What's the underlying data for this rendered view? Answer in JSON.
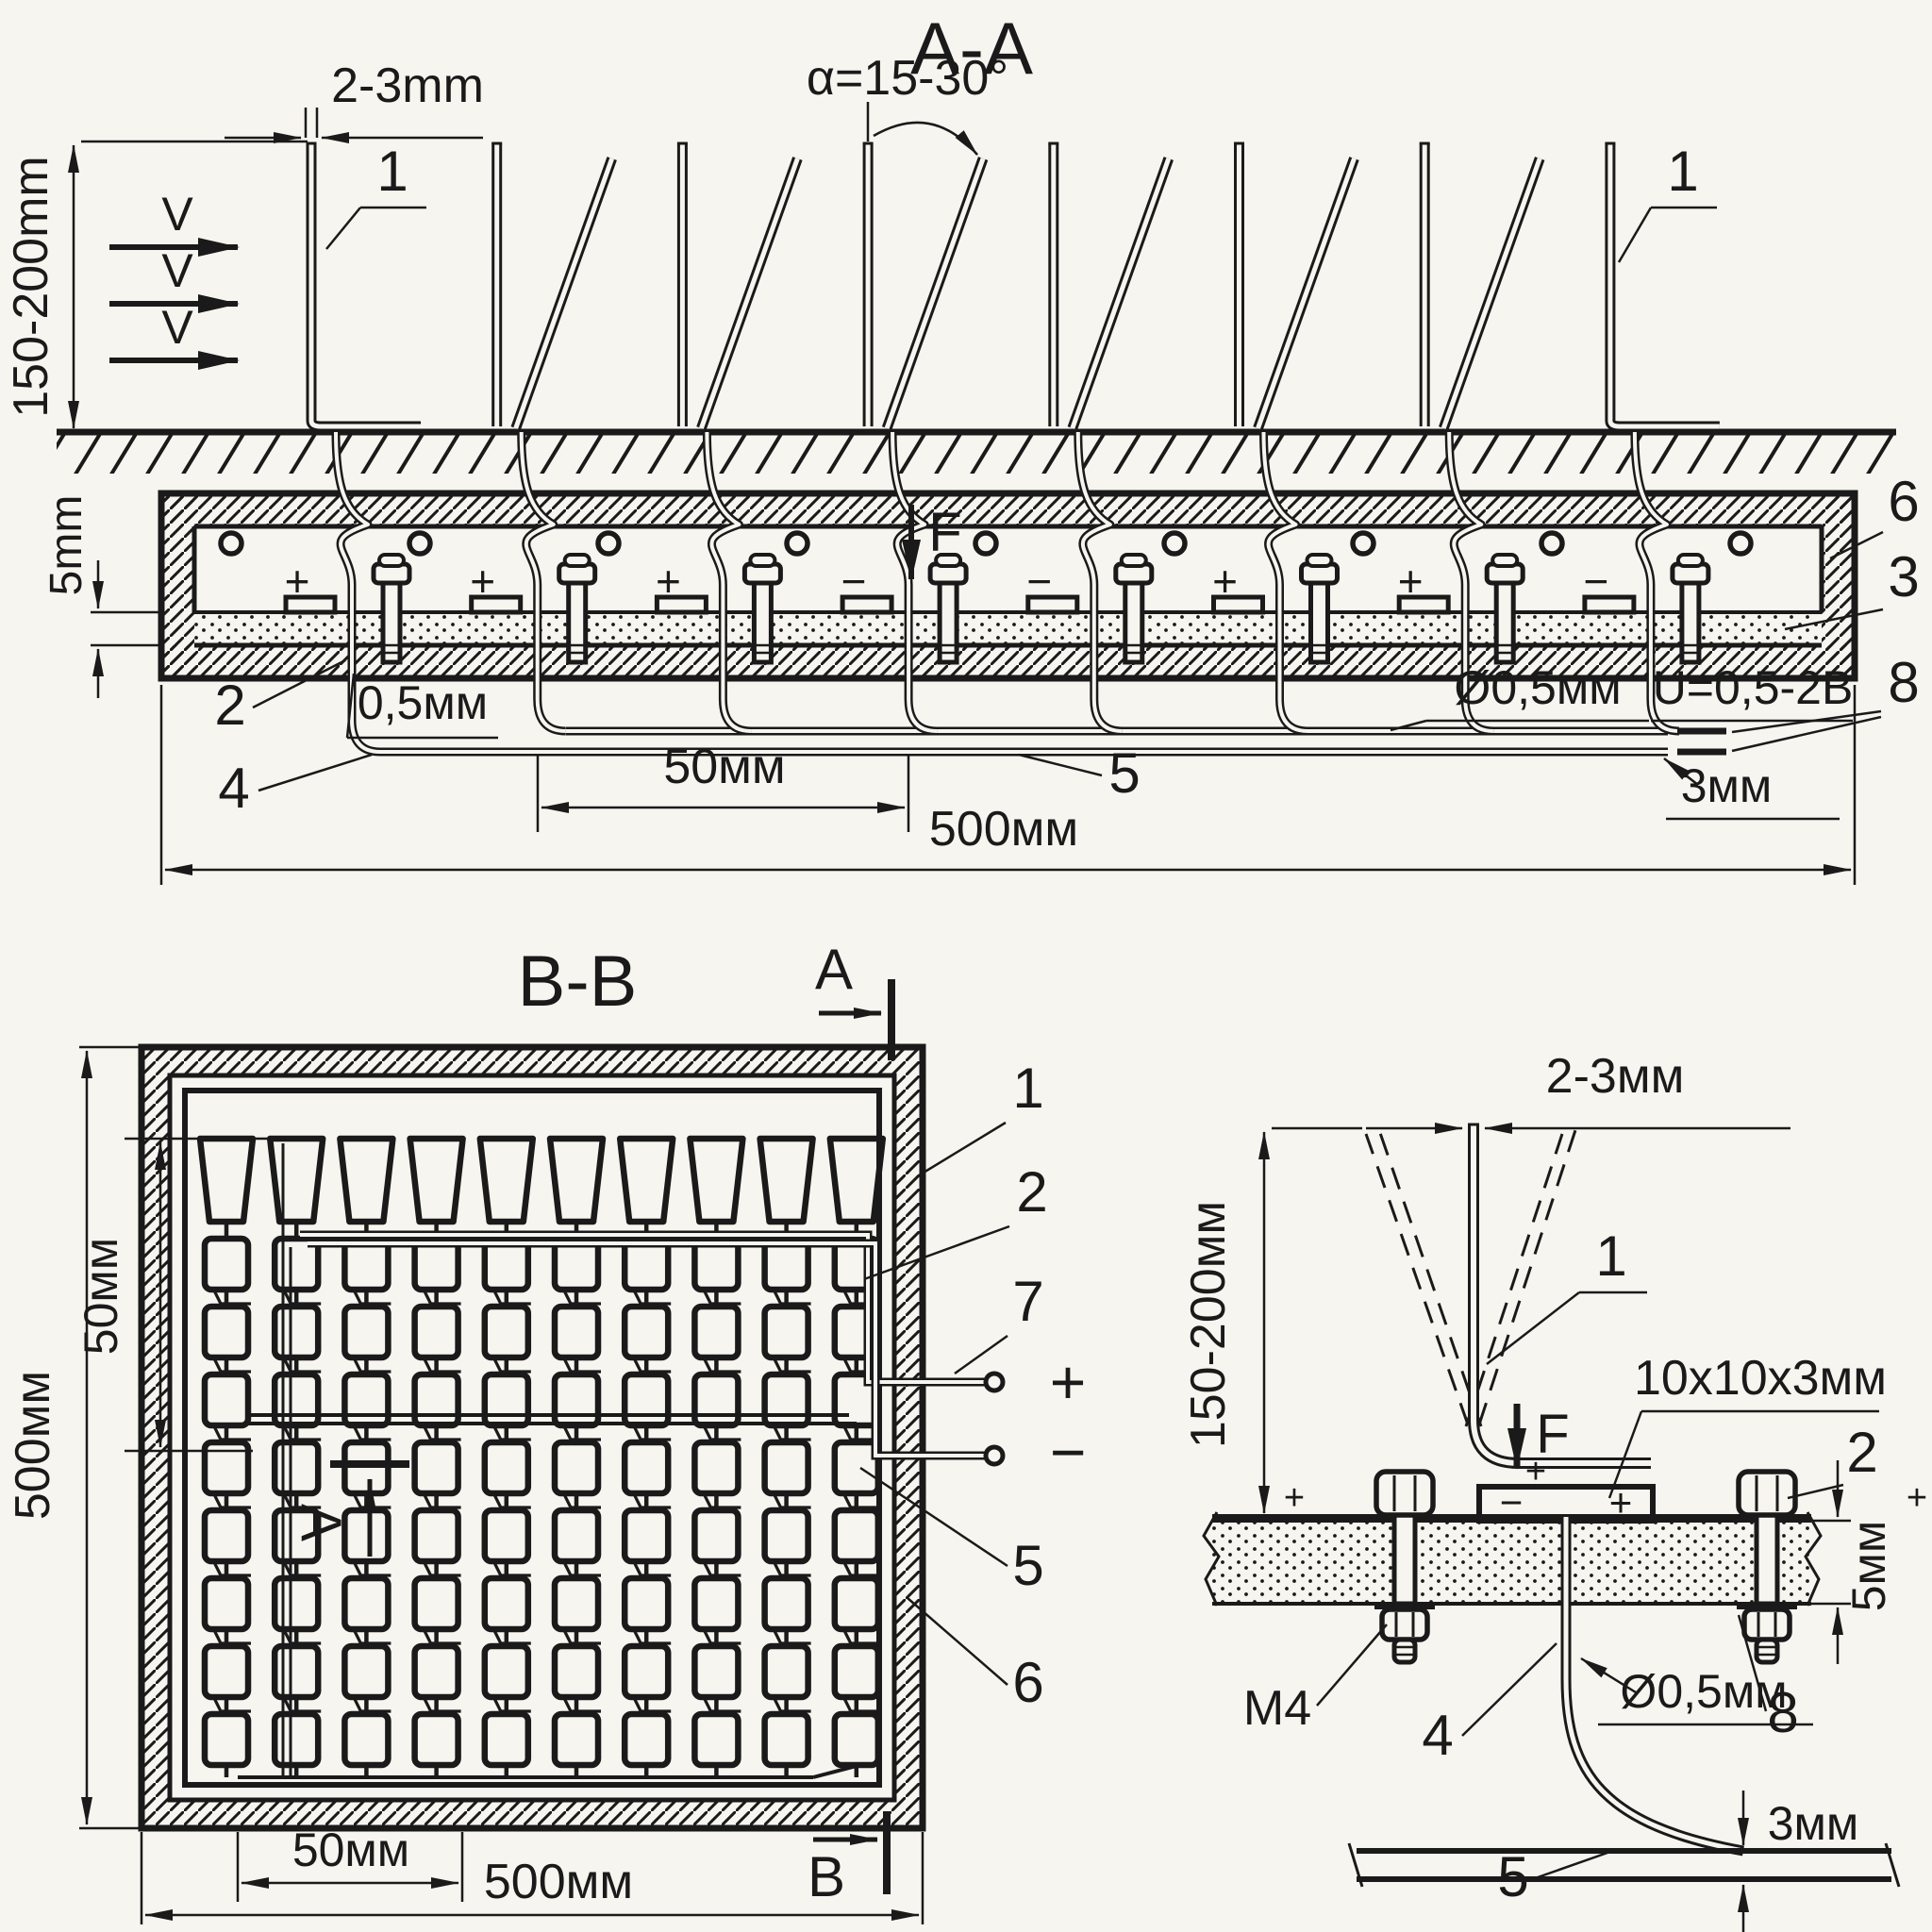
{
  "colors": {
    "paper": "#f7f5ef",
    "ink": "#1a1a1a"
  },
  "section_aa": {
    "title": "A-A",
    "dim_blade_gap": "2-3mm",
    "dim_angle": "α=15-30°",
    "dim_height": "150-200mm",
    "dim_board": "5mm",
    "dim_wire": "0,5мм",
    "dim_pitch": "50мм",
    "dim_width": "500мм",
    "dim_wire_dia": "Ø0,5мм",
    "voltage": "U=0,5-2В",
    "dim_bus": "3мм",
    "flow_labels": [
      "V",
      "V",
      "V"
    ],
    "force_label": "F",
    "label_blade_left": "1",
    "label_blade_right": "1",
    "label_wire_top": "2",
    "label_board": "3",
    "label_wire_bottom": "4",
    "label_bus": "5",
    "label_housing": "6",
    "label_sheet": "8",
    "polarity": [
      "+",
      "+",
      "+",
      "−",
      "−",
      "+",
      "+",
      "−"
    ],
    "dc_symbol": "="
  },
  "section_bb": {
    "title": "B-B",
    "mark_a_top": "A",
    "mark_a_left": "A",
    "mark_b": "B",
    "dim_height": "500мм",
    "dim_width": "500мм",
    "dim_pitch_vertical": "50мм",
    "dim_pitch_horizontal": "50мм",
    "label_frame": "1",
    "label_electrode": "2",
    "label_terminal": "7",
    "label_bus": "5",
    "label_housing": "6",
    "terminal_plus": "+",
    "terminal_minus": "−",
    "grid": {
      "cols": 10,
      "rows": 8
    }
  },
  "detail": {
    "dim_blade_gap": "2-3мм",
    "dim_height": "150-200мм",
    "pad_size": "10x10x3мм",
    "dim_board": "5мм",
    "dim_wire_dia": "Ø0,5мм",
    "dim_bus": "3мм",
    "thread": "M4",
    "label_blade": "1",
    "label_nut": "2",
    "label_wire": "4",
    "label_bus": "5",
    "label_washer": "8",
    "force_label": "F",
    "sign_foot": "+",
    "sign_block_left": "−",
    "sign_block_right": "+",
    "sign_sheet_left": "+",
    "sign_sheet_right": "+"
  }
}
